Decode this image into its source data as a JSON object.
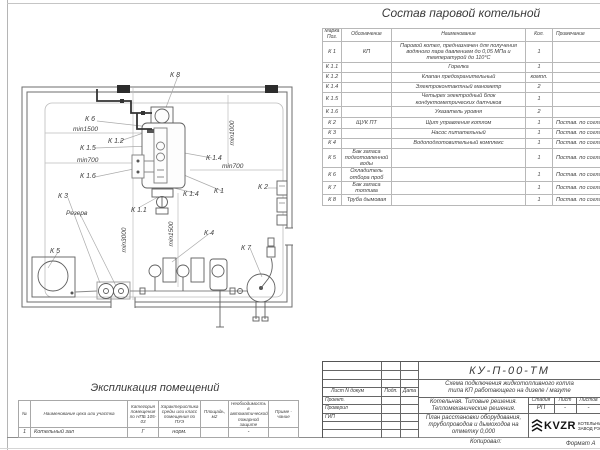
{
  "equipment_table": {
    "title": "Состав паровой котельной",
    "headers": [
      "Марка Поз.",
      "Обозначение",
      "Наименование",
      "Кол.",
      "Примечание"
    ],
    "rows": [
      {
        "pos": "К 1",
        "designation": "КП",
        "name": "Паровой котел, предназначен для получения водяного пара давлением до 0,05 МПа и температурой до  110°С",
        "qty": "1",
        "note": ""
      },
      {
        "pos": "К 1.1",
        "designation": "",
        "name": "Горелка",
        "qty": "1",
        "note": ""
      },
      {
        "pos": "К 1.2",
        "designation": "",
        "name": "Клапан предохранительный",
        "qty": "компл.",
        "note": ""
      },
      {
        "pos": "К 1.4",
        "designation": "",
        "name": "Электроконтактный манометр",
        "qty": "2",
        "note": ""
      },
      {
        "pos": "К 1.5",
        "designation": "",
        "name": "Четырех электродный блок кондуктометрических датчиков",
        "qty": "1",
        "note": ""
      },
      {
        "pos": "К 1.6",
        "designation": "",
        "name": "Указатель уровня",
        "qty": "2",
        "note": ""
      },
      {
        "pos": "К 2",
        "designation": "ЩУК ПТ",
        "name": "Щит управления котлом",
        "qty": "1",
        "note": "Постав. по согласован."
      },
      {
        "pos": "К 3",
        "designation": "",
        "name": "Насос питательный",
        "qty": "1",
        "note": "Постав. по согласован."
      },
      {
        "pos": "К 4",
        "designation": "",
        "name": "Водоподготовительный комплекс",
        "qty": "1",
        "note": "Постав. по согласован."
      },
      {
        "pos": "К 5",
        "designation": "Бак запаса подготовленной воды",
        "name": "",
        "qty": "1",
        "note": "Постав. по согласован."
      },
      {
        "pos": "К 6",
        "designation": "Охладитель отбора проб",
        "name": "",
        "qty": "1",
        "note": "Постав. по согласован."
      },
      {
        "pos": "К 7",
        "designation": "Бак запаса топлива",
        "name": "",
        "qty": "1",
        "note": "Постав. по согласован."
      },
      {
        "pos": "К 8",
        "designation": "Труба дымовая",
        "name": "",
        "qty": "1",
        "note": "Постав. по согласован."
      }
    ]
  },
  "plan": {
    "labels": {
      "k8": "К 8",
      "k6": "К 6",
      "min1500_a": "min1500",
      "k12": "К 1.2",
      "k15": "К 1.5",
      "min700_a": "min700",
      "k16": "К 1.6",
      "min1000": "min1000",
      "k14a": "К 1.4",
      "min700_b": "min700",
      "k2": "К 2",
      "k1": "К 1",
      "k14b": "К 1.4",
      "k11": "К 1.1",
      "k3": "К 3",
      "rezerv": "Резерв",
      "min3000": "min3000",
      "min1500_b": "min1500",
      "k5": "К 5",
      "k4": "К 4",
      "k7": "К 7"
    }
  },
  "explication": {
    "title": "Экспликация помещений",
    "headers": [
      "№",
      "Наименование цеха или участка",
      "Категория помещения по НПБ 105-03",
      "Характеристика среды или класс помещения по ПУЭ",
      "Площадь, м2",
      "Необходимость в автоматической пожарной защите",
      "Приме - чание"
    ],
    "rows": [
      [
        "1",
        "Котельный зал",
        "Г",
        "норм.",
        "",
        "-",
        ""
      ]
    ]
  },
  "title_block": {
    "doc_number": "КУ-П-00-ТМ",
    "doc_title_line1": "Схема подключения жидкотопливного котла",
    "doc_title_line2": "типа КП работающего на дизеле / мазуте",
    "col_docum": "Лист N докум",
    "col_sign": "Подп.",
    "col_date": "Дата",
    "role_1": "Проект.",
    "role_2": "Проверил",
    "role_3": "ГИП",
    "project_line1": "Котельная. Типовые решения.",
    "project_line2": "Тепломеханические решения.",
    "stage_h1": "Стадия",
    "stage_h2": "Лист",
    "stage_h3": "Листов",
    "stage_v1": "РП",
    "stage_v2": "-",
    "stage_v3": "-",
    "sheet_title_line1": "План расстановки оборудования,",
    "sheet_title_line2": "трубопроводов и дымоходов на",
    "sheet_title_line3": "отметку 0,000",
    "logo_text": "KVZR",
    "company_line1": "КОТЕЛЬНЫЙ",
    "company_line2": "ЗАВОД РЭ",
    "copied_label": "Копировал:",
    "format_label": "Формат А"
  }
}
